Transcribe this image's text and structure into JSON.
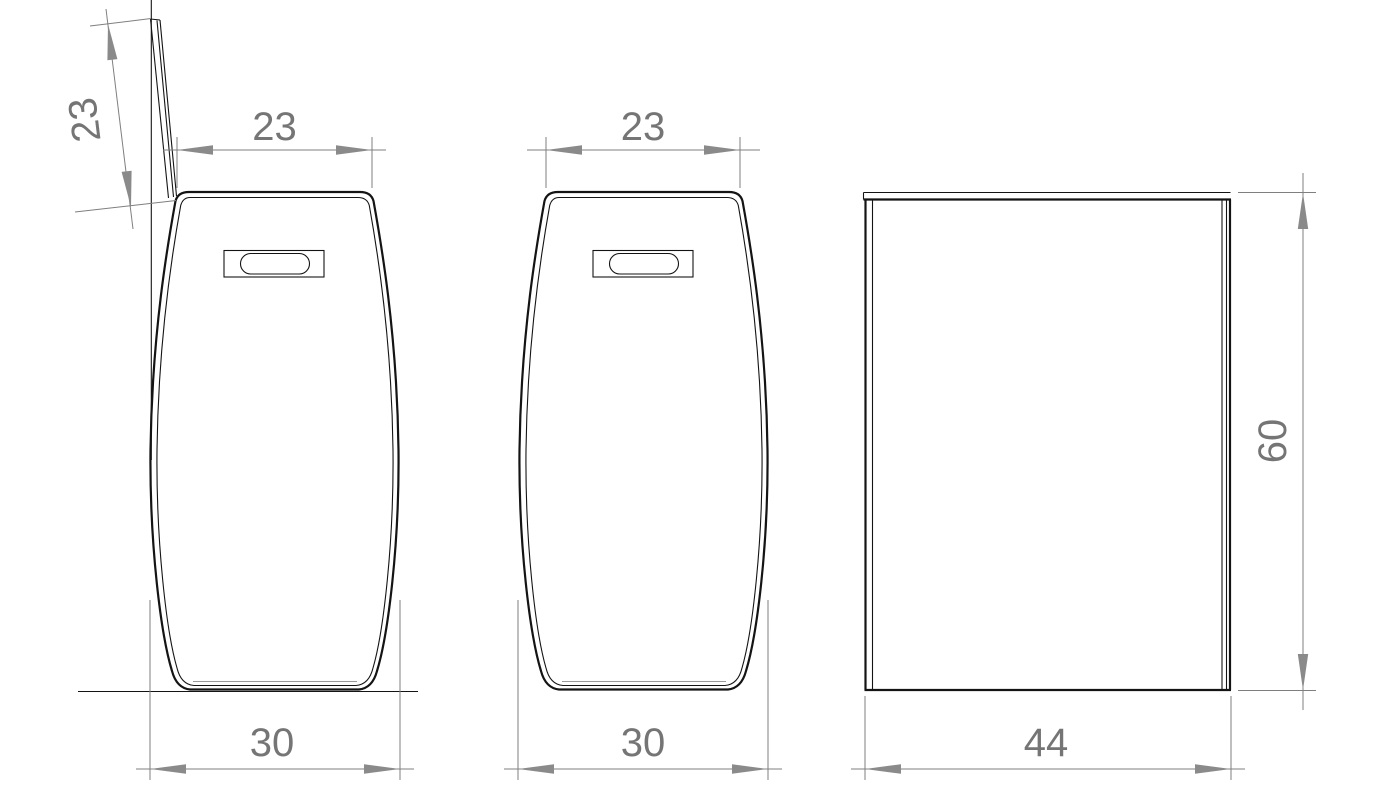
{
  "drawing": {
    "type": "cad-orthographic-views",
    "subject": "laundry-basket-with-lid",
    "units_shown": false,
    "colors": {
      "background": "#ffffff",
      "geometry": "#141414",
      "dimension_gray": "#7f7f7f",
      "text_gray": "#757575"
    },
    "views": {
      "front_open": {
        "label": "front view, lid open",
        "dims": {
          "lid_depth": "23",
          "top_width": "23",
          "max_width": "30"
        }
      },
      "front": {
        "label": "front view",
        "dims": {
          "top_width": "23",
          "max_width": "30"
        }
      },
      "side": {
        "label": "side view",
        "dims": {
          "depth": "44",
          "height": "60"
        }
      }
    }
  }
}
